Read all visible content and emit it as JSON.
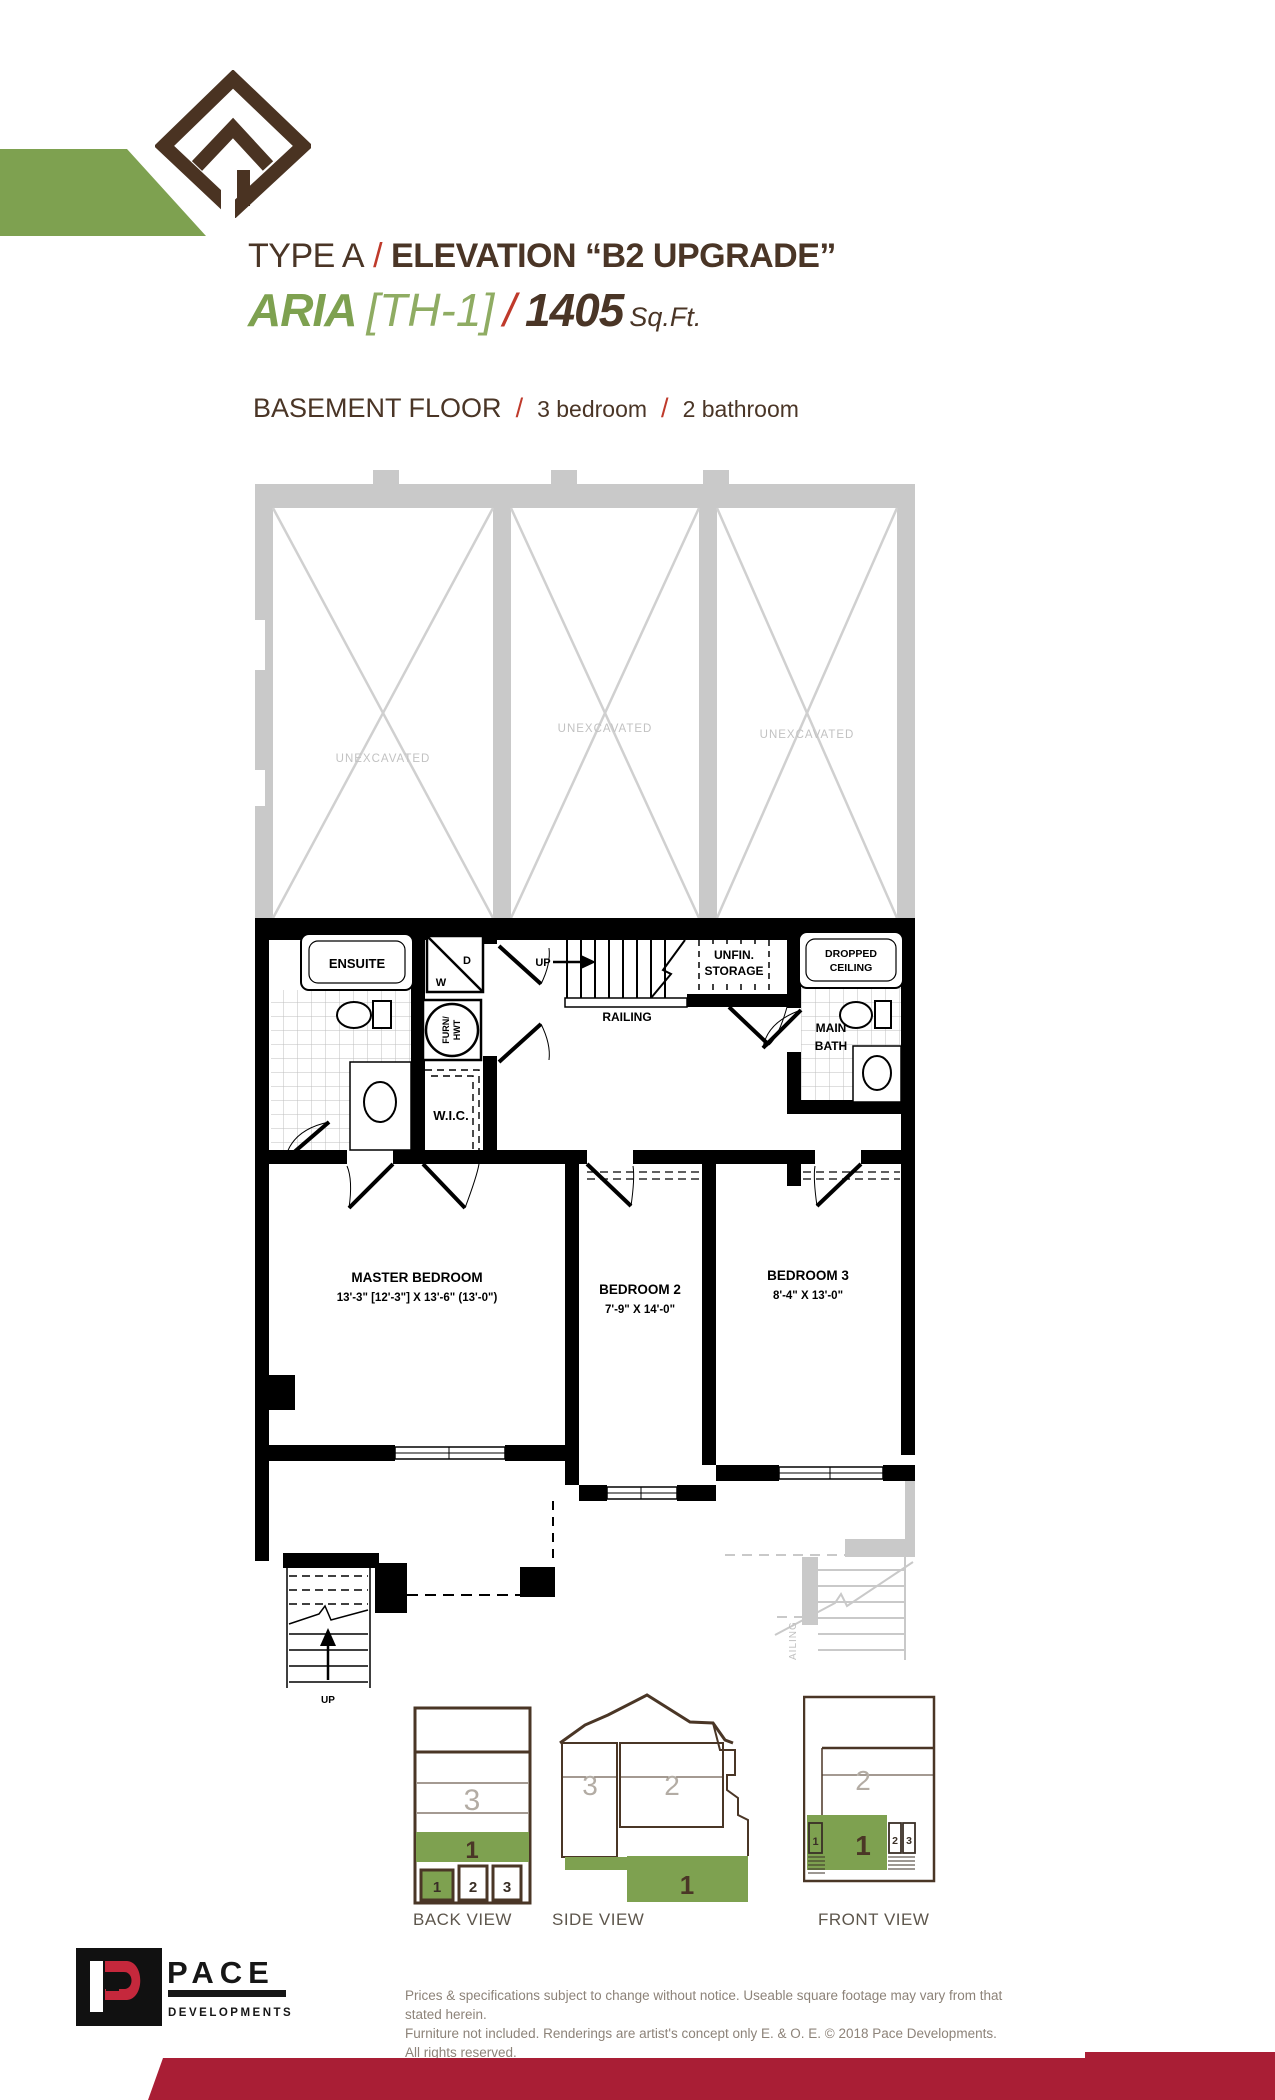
{
  "header": {
    "type": "TYPE A",
    "slash": "/",
    "elevation": "ELEVATION “B2 UPGRADE”",
    "model": "ARIA",
    "unit": "[TH-1]",
    "sqft": "1405",
    "sqft_label": "Sq.Ft.",
    "floor": "BASEMENT FLOOR",
    "beds": "3 bedroom",
    "baths": "2 bathroom"
  },
  "plan": {
    "unexcavated": [
      "UNEXCAVATED",
      "UNEXCAVATED",
      "UNEXCAVATED"
    ],
    "ensuite": "ENSUITE",
    "wd_d": "D",
    "wd_w": "W",
    "furn1": "FURN/",
    "furn2": "HWT",
    "wic": "W.I.C.",
    "up_stair": "UP",
    "railing": "RAILING",
    "unfin1": "UNFIN.",
    "unfin2": "STORAGE",
    "dropped1": "DROPPED",
    "dropped2": "CEILING",
    "main1": "MAIN",
    "main2": "BATH",
    "master": "MASTER BEDROOM",
    "master_dims": "13'-3\" [12'-3\"]  X 13'-6\" (13'-0\")",
    "bed2": "BEDROOM 2",
    "bed2_dims": "7'-9\" X 14'-0\"",
    "bed3": "BEDROOM 3",
    "bed3_dims": "8'-4\" X 13'-0\"",
    "railing_side": "AILING",
    "up_exterior": "UP"
  },
  "views": {
    "back": {
      "label": "BACK VIEW",
      "upper": "3",
      "band": "1",
      "units": [
        "1",
        "2",
        "3"
      ]
    },
    "side": {
      "label": "SIDE VIEW",
      "left": "3",
      "mid": "2",
      "band": "1"
    },
    "front": {
      "label": "FRONT VIEW",
      "upper": "2",
      "band": "1",
      "units": [
        "1",
        "2",
        "3"
      ]
    }
  },
  "footer": {
    "brand": "PACE",
    "brand_sub": "DEVELOPMENTS",
    "disclaimer1": "Prices & specifications subject to change without notice. Useable square footage may vary from that stated herein.",
    "disclaimer2": "Furniture not included. Renderings are artist's concept only E. & O. E. © 2018 Pace Developments. All rights reserved."
  },
  "colors": {
    "brown": "#4a3526",
    "green": "#7ea150",
    "red_slash": "#bf3a2b",
    "band_red": "#a91e35",
    "plan_gray": "#c9c9c9",
    "number_gray": "#b3aca4"
  }
}
